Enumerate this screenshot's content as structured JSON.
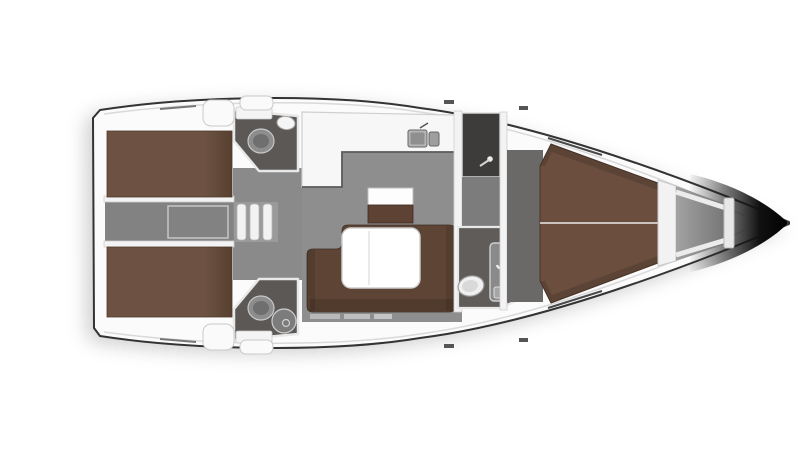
{
  "diagram": {
    "type": "yacht-interior-floor-plan",
    "orientation": "bow-right"
  },
  "colors": {
    "background": "#ffffff",
    "hull_fill": "#fbfbfb",
    "hull_outline": "#333333",
    "deck_inner_line": "#d9d9d9",
    "wall_white": "#f3f3f3",
    "fixture_white": "#f2f2f2",
    "salon_floor": "#8e8e8e",
    "landing_floor": "#8a8a8a",
    "engine_corridor": "#828282",
    "vestibule_floor": "#7c7c7c",
    "cabin_entry_floor": "#6b6968",
    "head_floor": "#5b5856",
    "fwd_head_floor": "#5f5c59",
    "dark_locker": "#3e3c3a",
    "bed_brown": "#6d5243",
    "fwd_bed_brown": "#6b4e3e",
    "sofa_brown": "#5d4434",
    "cabinet_brown": "#5e4233",
    "table_white": "#ffffff",
    "anchor_locker_grey": "#989898",
    "sink_grey": "#9e9e9e",
    "toilet_grey": "#8d8d8d",
    "bow_tip_dark": "#0b0b0b"
  },
  "regions": [
    {
      "name": "aft-cabin-port"
    },
    {
      "name": "aft-cabin-starboard"
    },
    {
      "name": "aft-head-port"
    },
    {
      "name": "aft-head-starboard"
    },
    {
      "name": "engine-corridor"
    },
    {
      "name": "companionway-steps"
    },
    {
      "name": "galley"
    },
    {
      "name": "salon"
    },
    {
      "name": "chart-cabinet"
    },
    {
      "name": "sofa"
    },
    {
      "name": "salon-table"
    },
    {
      "name": "wet-locker"
    },
    {
      "name": "forward-head"
    },
    {
      "name": "forward-cabin"
    },
    {
      "name": "anchor-locker"
    },
    {
      "name": "bow"
    }
  ]
}
